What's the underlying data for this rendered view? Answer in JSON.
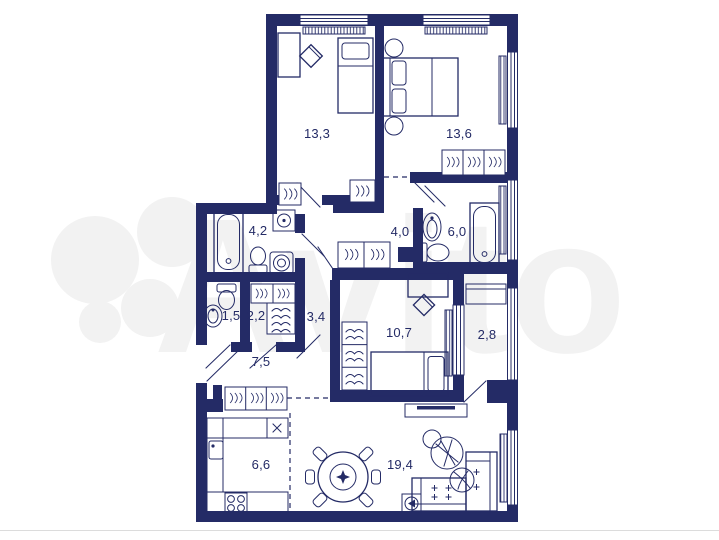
{
  "watermark": {
    "brand": "Avito"
  },
  "plan": {
    "colors": {
      "wall": "#242b66",
      "label": "#242b66",
      "watermark": "#f2f2f2",
      "divider": "#dcdcdc",
      "background": "#ffffff"
    },
    "rooms": [
      {
        "id": "bedroom-1",
        "area": "13,3"
      },
      {
        "id": "bedroom-2",
        "area": "13,6"
      },
      {
        "id": "bathroom-1",
        "area": "4,2"
      },
      {
        "id": "hall-upper",
        "area": "4,0"
      },
      {
        "id": "bathroom-2",
        "area": "6,0"
      },
      {
        "id": "wc",
        "area": "1,5"
      },
      {
        "id": "closet",
        "area": "2,2"
      },
      {
        "id": "corridor",
        "area": "3,4"
      },
      {
        "id": "bedroom-3",
        "area": "10,7"
      },
      {
        "id": "loggia",
        "area": "2,8"
      },
      {
        "id": "hallway",
        "area": "7,5"
      },
      {
        "id": "kitchen",
        "area": "6,6"
      },
      {
        "id": "living-room",
        "area": "19,4"
      }
    ],
    "icons": [
      "double-bed",
      "single-bed",
      "desk",
      "desk-chair",
      "wardrobe-hangers",
      "shelves",
      "chest-of-drawers",
      "bathtub",
      "toilet",
      "sink",
      "washing-machine",
      "kitchen-counter",
      "kitchen-sink",
      "hob",
      "stove-burners",
      "dining-table",
      "dining-chair",
      "corner-sofa",
      "tv-stand",
      "floor-lamp",
      "plant",
      "radiator",
      "window",
      "door-leaf"
    ]
  }
}
